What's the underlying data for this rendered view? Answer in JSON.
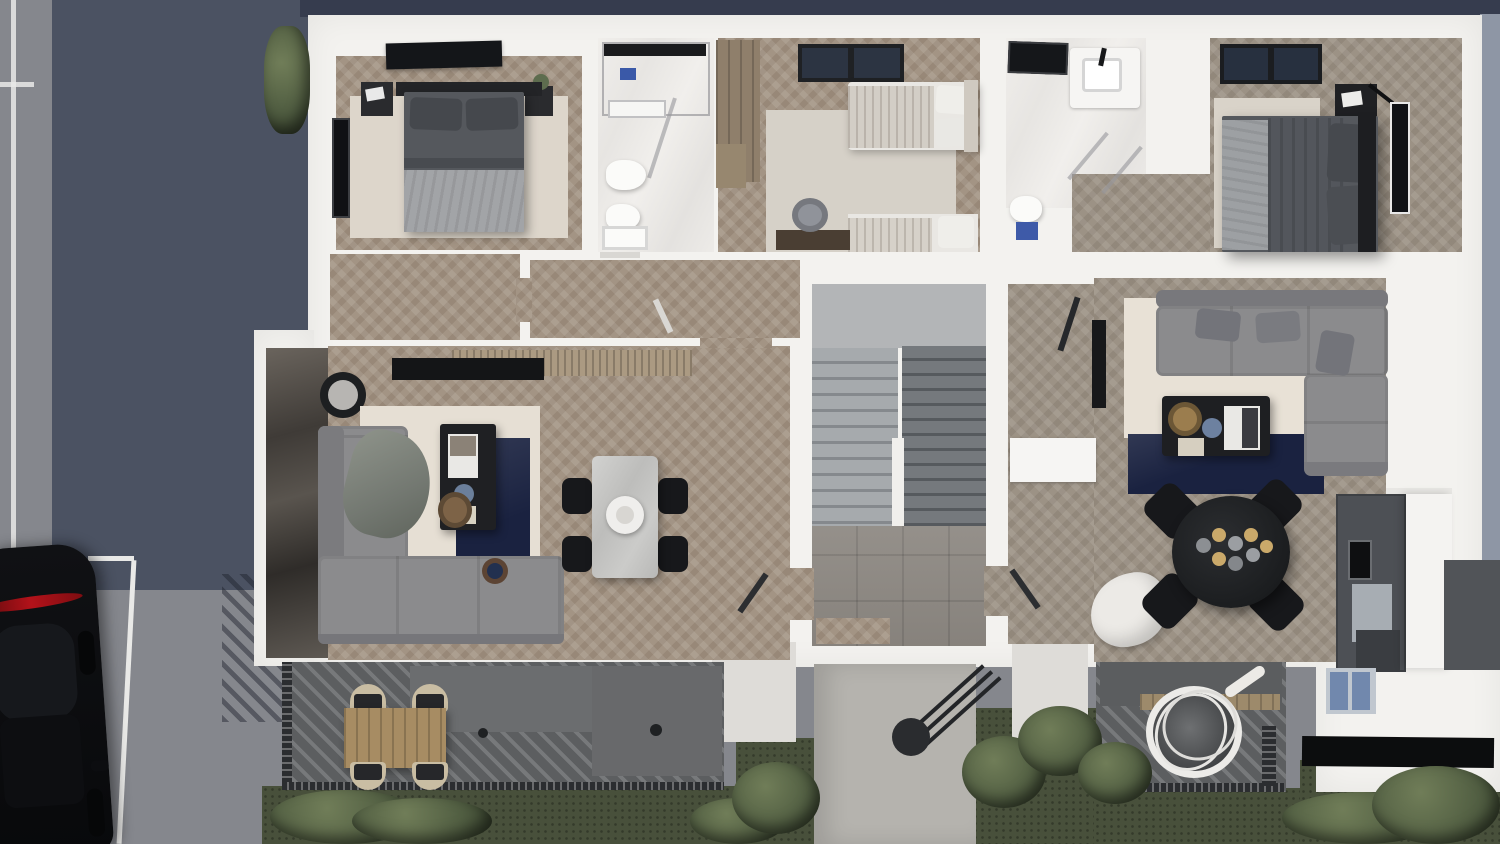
{
  "meta": {
    "title": "Top-down 3D architectural floor plan render",
    "view": "bird's-eye cutaway of an apartment floor with two units, street and garden"
  },
  "palette": {
    "sky_band": "#363c4e",
    "road": "#85878d",
    "road_shadow": "#4b5262",
    "road_line": "#e9e9e7",
    "ground_right": "#8e96a5",
    "building": "#f3f2ef",
    "wood": "#a39484",
    "wood_right": "#9c9285",
    "tile_entry": "#8f8a84",
    "stair_light": "#a6aaad",
    "stair_dark": "#75797d",
    "terrace": "#5c5e60",
    "railing": "#2b2d30",
    "grass": "#48503b",
    "path": "#b5b3ae",
    "rug_navy": "#1a2240",
    "rug_beige": "#e6dfd4",
    "sofa": "#8b8b8d",
    "bed_dark": "#55585d",
    "bed_light": "#a2a4a7",
    "black_furniture": "#1f2023",
    "wood_table": "#a78c63",
    "kitchen_dark": "#4d5055",
    "car_body": "#0b0c0e",
    "taillight_red": "#b3121a"
  },
  "scene": {
    "environment": {
      "road": {
        "label": "street with parking lines",
        "markings": "white parking lines"
      },
      "car": {
        "label": "black car parked on street"
      },
      "garden": {
        "label": "garden with grass and round bushes"
      },
      "path": {
        "label": "concrete entrance path with cantilever canopy"
      }
    },
    "building": {
      "label": "apartment floor cutaway",
      "staircase": {
        "label": "central staircase with two flights and entry vestibule"
      },
      "left_apartment": {
        "label": "left apartment",
        "rooms": [
          {
            "name": "bedroom",
            "furniture": [
              "double bed",
              "nightstands",
              "wall art panel",
              "rug",
              "window"
            ]
          },
          {
            "name": "bathroom",
            "furniture": [
              "shower",
              "towel rail",
              "toilet",
              "bidet",
              "washbasin"
            ]
          },
          {
            "name": "kids room",
            "furniture": [
              "wardrobe",
              "two single beds",
              "desk",
              "chair",
              "rug",
              "window"
            ]
          },
          {
            "name": "hallway",
            "furniture": []
          },
          {
            "name": "living room",
            "furniture": [
              "corner sofa",
              "coffee table",
              "side tables",
              "navy rug",
              "beige rug",
              "dining table",
              "four chairs",
              "tv sideboard",
              "marble accent wall"
            ]
          },
          {
            "name": "terrace",
            "furniture": [
              "outdoor dining table",
              "four chairs",
              "railing"
            ]
          }
        ]
      },
      "right_apartment": {
        "label": "right apartment",
        "rooms": [
          {
            "name": "bathroom",
            "furniture": [
              "skylight",
              "vanity basin",
              "shower",
              "toilet"
            ]
          },
          {
            "name": "bedroom",
            "furniture": [
              "double bed",
              "nightstand with lamp",
              "wall art",
              "rug",
              "window"
            ]
          },
          {
            "name": "hallway",
            "furniture": [
              "white cabinet",
              "draped blanket"
            ]
          },
          {
            "name": "living room",
            "furniture": [
              "corner sofa",
              "coffee table",
              "navy rug",
              "beige rug",
              "round dining table",
              "four chairs",
              "wall tv"
            ]
          },
          {
            "name": "kitchen",
            "furniture": [
              "tall dark cabinets",
              "built-in oven",
              "fridge",
              "white island",
              "beverage coolers",
              "black glass window band"
            ]
          },
          {
            "name": "terrace",
            "furniture": [
              "hanging egg chair",
              "bench",
              "railing"
            ]
          }
        ]
      }
    }
  }
}
